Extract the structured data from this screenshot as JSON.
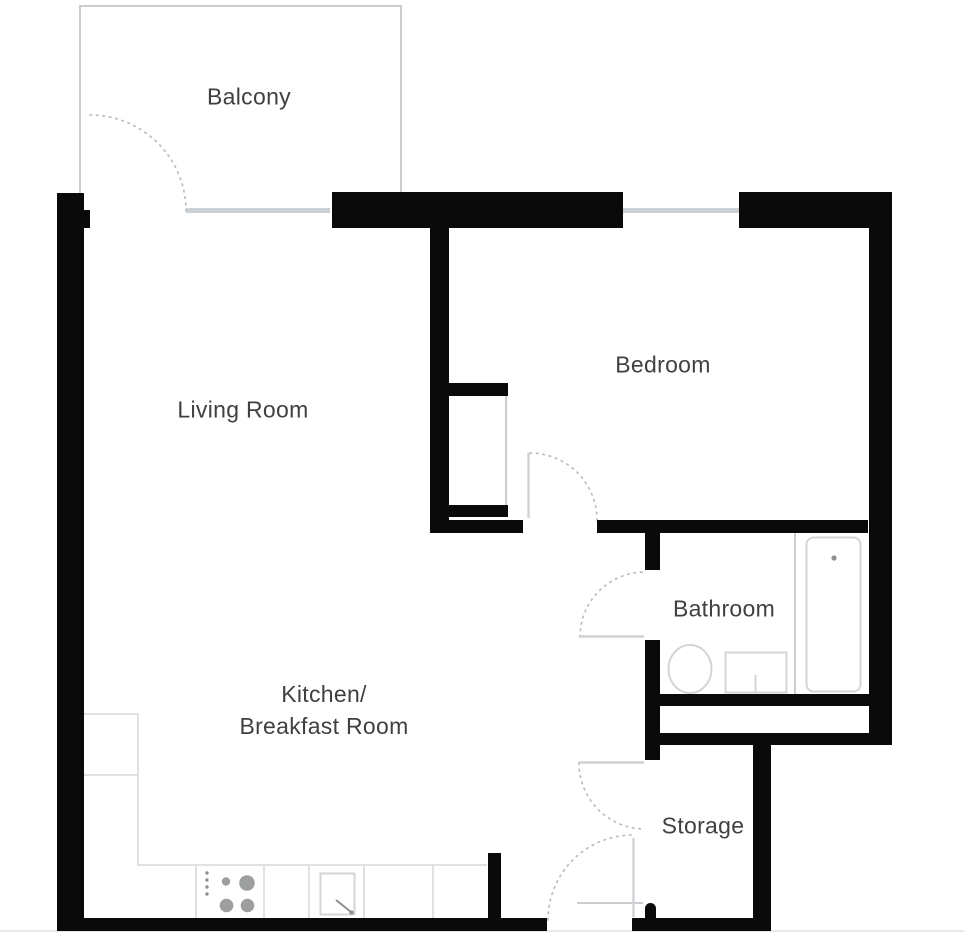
{
  "theme": {
    "wall": "#0a0a0a",
    "line": "#c9ccd0",
    "win": "#ccd1d5",
    "counter": "#dfe1e2",
    "arc": "#b9bcbe",
    "leaf": "#cfd2d4",
    "fixture": "#d3d5d7",
    "burner": "#9c9ea0",
    "knob": "#8d8f91",
    "text": "#3e4042",
    "edge": "#e6e8ea",
    "bg": "#ffffff"
  },
  "rooms": {
    "balcony": {
      "label": "Balcony"
    },
    "living_room": {
      "label": "Living Room"
    },
    "bedroom": {
      "label": "Bedroom"
    },
    "kitchen": {
      "line1": "Kitchen/",
      "line2": "Breakfast Room"
    },
    "bathroom": {
      "label": "Bathroom"
    },
    "storage": {
      "label": "Storage"
    }
  },
  "fixtures": {
    "bathroom": [
      "bathtub",
      "toilet",
      "sink"
    ],
    "kitchen": [
      "counter",
      "stove",
      "sink"
    ],
    "bedroom": [
      "wardrobe"
    ],
    "doors": [
      "balcony-door",
      "bedroom-door",
      "bathroom-door",
      "storage-door",
      "entrance-door"
    ],
    "windows": [
      "balcony-glazing",
      "bedroom-window"
    ]
  }
}
